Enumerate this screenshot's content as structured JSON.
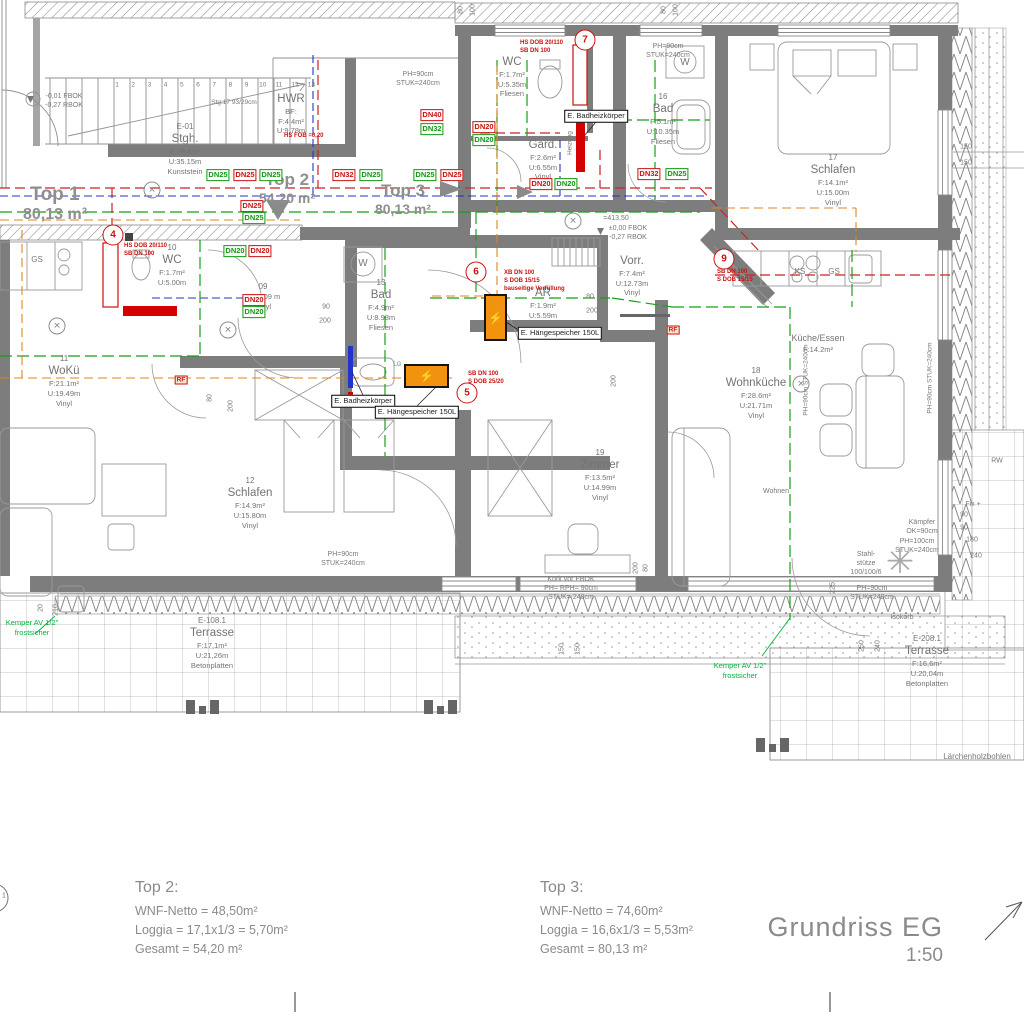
{
  "title": {
    "text": "Grundriss EG",
    "scale": "1:50"
  },
  "summaries": [
    {
      "heading": "Top 2:",
      "lines": [
        "WNF-Netto = 48,50m²",
        "Loggia = 17,1x1/3 = 5,70m²",
        "Gesamt = 54,20 m²"
      ]
    },
    {
      "heading": "Top 3:",
      "lines": [
        "WNF-Netto = 74,60m²",
        "Loggia = 16,6x1/3 = 5,53m²",
        "Gesamt = 80,13 m²"
      ]
    }
  ],
  "units": [
    {
      "name": "Top 1",
      "area": "80,13 m²",
      "x": 55,
      "y": 184,
      "size": 19
    },
    {
      "name": "Top 2",
      "area": "54,20 m²",
      "x": 287,
      "y": 170,
      "size": 17
    },
    {
      "name": "Top 3",
      "area": "80,13 m²",
      "x": ": 0",
      "size": 0
    },
    {
      "name": "Top 3",
      "area": "80,13 m²",
      "x": 403,
      "y": 181,
      "size": 17
    }
  ],
  "rooms": [
    {
      "number": "E-01",
      "name": "Stgh.",
      "lines": [
        "F:29.6m²",
        "U:35.15m",
        "Kunststein"
      ],
      "x": 185,
      "y": 122
    },
    {
      "number": "",
      "name": "HWR",
      "lines": [
        "BF:",
        "F:4.4m²",
        "U:9.78m"
      ],
      "x": 291,
      "y": 92
    },
    {
      "number": "",
      "name": "WC",
      "lines": [
        "F:1.7m²",
        "U:5.35m",
        "Fliesen"
      ],
      "x": 512,
      "y": 55
    },
    {
      "number": "",
      "name": "Gard.",
      "lines": [
        "F:2.6m²",
        "U:6.55m",
        "Vinyl"
      ],
      "x": 543,
      "y": 138
    },
    {
      "number": "16",
      "name": "Bad",
      "lines": [
        "F:5.1m²",
        "U:10.35m",
        "Fliesen"
      ],
      "x": 663,
      "y": 92
    },
    {
      "number": "17",
      "name": "Schlafen",
      "lines": [
        "F:14.1m²",
        "U:15.00m",
        "Vinyl"
      ],
      "x": 833,
      "y": 153
    },
    {
      "number": "10",
      "name": "WC",
      "lines": [
        "F:1.7m²",
        "U:5.00m"
      ],
      "x": 172,
      "y": 243
    },
    {
      "number": "09",
      "name": "",
      "lines": [
        "U:10.09 m",
        "Vinyl"
      ],
      "x": 263,
      "y": 282
    },
    {
      "number": "11",
      "name": "WoKü",
      "lines": [
        "F:21.1m²",
        "U:19.49m",
        "Vinyl"
      ],
      "x": 64,
      "y": 354
    },
    {
      "number": "13",
      "name": "Bad",
      "lines": [
        "F:4.9m²",
        "U:8.98m",
        "Fliesen"
      ],
      "x": 381,
      "y": 278
    },
    {
      "number": "",
      "name": "AR",
      "lines": [
        "F:1.9m²",
        "U:5.59m"
      ],
      "x": 543,
      "y": 286
    },
    {
      "number": "",
      "name": "Vorr.",
      "lines": [
        "F:7.4m²",
        "U:12.73m",
        "Vinyl"
      ],
      "x": 632,
      "y": 254
    },
    {
      "number": "12",
      "name": "Schlafen",
      "lines": [
        "F:14.9m²",
        "U:15.80m",
        "Vinyl"
      ],
      "x": 250,
      "y": 476
    },
    {
      "number": "19",
      "name": "Zimmer",
      "lines": [
        "F:13.5m²",
        "U:14.99m",
        "Vinyl"
      ],
      "x": 600,
      "y": 448
    },
    {
      "number": "18",
      "name": "Wohnküche",
      "lines": [
        "F:28.6m²",
        "U:21.71m",
        "Vinyl"
      ],
      "x": 756,
      "y": 366
    },
    {
      "number": "",
      "name": "Küche/Essen",
      "small": true,
      "lines": [
        "F:14.2m²"
      ],
      "x": 818,
      "y": 333
    },
    {
      "number": "E-108.1",
      "name": "Terrasse",
      "lines": [
        "F:17,1m²",
        "U:21,26m",
        "Betonplatten"
      ],
      "x": 212,
      "y": 616
    },
    {
      "number": "E-208.1",
      "name": "Terrasse",
      "lines": [
        "F:16,6m²",
        "U:20,04m",
        "Betonplatten"
      ],
      "x": 927,
      "y": 634
    }
  ],
  "dn_labels": [
    {
      "t": "DN25",
      "c": "green",
      "x": 218,
      "y": 175
    },
    {
      "t": "DN25",
      "c": "red",
      "x": 245,
      "y": 175
    },
    {
      "t": "DN25",
      "c": "green",
      "x": 271,
      "y": 175
    },
    {
      "t": "DN32",
      "c": "red",
      "x": 344,
      "y": 175
    },
    {
      "t": "DN25",
      "c": "green",
      "x": 371,
      "y": 175
    },
    {
      "t": "DN25",
      "c": "green",
      "x": 425,
      "y": 175
    },
    {
      "t": "DN25",
      "c": "red",
      "x": 452,
      "y": 175
    },
    {
      "t": "DN25",
      "c": "red",
      "x": 252,
      "y": 206
    },
    {
      "t": "DN25",
      "c": "green",
      "x": 254,
      "y": 218
    },
    {
      "t": "DN40",
      "c": "red",
      "x": 432,
      "y": 115
    },
    {
      "t": "DN32",
      "c": "green",
      "x": 432,
      "y": 129
    },
    {
      "t": "DN20",
      "c": "red",
      "x": 484,
      "y": 127
    },
    {
      "t": "DN20",
      "c": "green",
      "x": 484,
      "y": 140
    },
    {
      "t": "DN20",
      "c": "green",
      "x": 235,
      "y": 251
    },
    {
      "t": "DN20",
      "c": "red",
      "x": 260,
      "y": 251
    },
    {
      "t": "DN20",
      "c": "red",
      "x": 254,
      "y": 300
    },
    {
      "t": "DN20",
      "c": "green",
      "x": 254,
      "y": 312
    },
    {
      "t": "DN20",
      "c": "red",
      "x": 541,
      "y": 184
    },
    {
      "t": "DN20",
      "c": "green",
      "x": 566,
      "y": 184
    },
    {
      "t": "DN32",
      "c": "red",
      "x": 649,
      "y": 174
    },
    {
      "t": "DN25",
      "c": "green",
      "x": 677,
      "y": 174
    }
  ],
  "markers": [
    {
      "n": "4",
      "x": 113,
      "y": 235
    },
    {
      "n": "5",
      "x": 467,
      "y": 393
    },
    {
      "n": "6",
      "x": 476,
      "y": 272
    },
    {
      "n": "7",
      "x": 585,
      "y": 40
    },
    {
      "n": "9",
      "x": 724,
      "y": 259
    }
  ],
  "boxed_labels": [
    {
      "t": "E. Badheizkörper",
      "x": 596,
      "y": 116
    },
    {
      "t": "E. Badheizkörper",
      "x": 363,
      "y": 401
    },
    {
      "t": "E. Hängespeicher 150L",
      "x": 560,
      "y": 333
    },
    {
      "t": "E. Hängespeicher 150L",
      "x": 417,
      "y": 412
    }
  ],
  "red_notes": [
    {
      "lines": [
        "HS DOB 20/110",
        "SB DN 100"
      ],
      "x": 124,
      "y": 243
    },
    {
      "lines": [
        "HS DOB 20/110",
        "SB DN 100"
      ],
      "x": 520,
      "y": 40
    },
    {
      "lines": [
        "HS FOB =0,20"
      ],
      "x": 284,
      "y": 133
    },
    {
      "lines": [
        "XB DN 100",
        "S DOB 15/15",
        "bauseitige Verfüllung"
      ],
      "x": 504,
      "y": 270
    },
    {
      "lines": [
        "SB DN 100",
        "S DOB 25/20"
      ],
      "x": 468,
      "y": 371
    },
    {
      "lines": [
        "SB DN 100",
        "S DOB 15/15"
      ],
      "x": 717,
      "y": 269
    }
  ],
  "green_notes": [
    {
      "lines": [
        "Kemper AV 1/2\"",
        "frostsicher"
      ],
      "x": 32,
      "y": 618
    },
    {
      "lines": [
        "Kemper AV 1/2\"",
        "frostsicher"
      ],
      "x": 740,
      "y": 661
    }
  ],
  "gray_notes": [
    {
      "lines": [
        "-0,01 FBOK",
        "-0,27 RBOK"
      ],
      "x": 64,
      "y": 92
    },
    {
      "lines": [
        "=413,50"
      ],
      "x": 616,
      "y": 214
    },
    {
      "lines": [
        "±0,00 FBOK",
        "-0,27 RBOK"
      ],
      "x": 628,
      "y": 224
    },
    {
      "lines": [
        "Stg:17 93/29cm"
      ],
      "x": 234,
      "y": 99,
      "size": 6.5
    },
    {
      "lines": [
        "PH=90cm",
        "STUK=240cm"
      ],
      "x": 418,
      "y": 70
    },
    {
      "lines": [
        "PH=90cm",
        "STUK=240cm"
      ],
      "x": 668,
      "y": 42
    },
    {
      "lines": [
        "PH=90cm",
        "STUK=240cm"
      ],
      "x": 343,
      "y": 550
    },
    {
      "lines": [
        "Kork vor FBOK",
        "PH= RPH= 90cm",
        "STUK= 240cm"
      ],
      "x": 571,
      "y": 575
    },
    {
      "lines": [
        "Kämpfer",
        "OK=90cm"
      ],
      "x": 922,
      "y": 518
    },
    {
      "lines": [
        "PH=100cm",
        "STUK=240cm"
      ],
      "x": 917,
      "y": 537
    },
    {
      "lines": [
        "PH=90cm",
        "STUK=240cm"
      ],
      "x": 872,
      "y": 584
    },
    {
      "lines": [
        "Stahl-",
        "stütze",
        "100/100/6"
      ],
      "x": 866,
      "y": 550
    },
    {
      "lines": [
        "Wohnen"
      ],
      "x": 776,
      "y": 487
    },
    {
      "lines": [
        "Isokorb"
      ],
      "x": 902,
      "y": 613
    },
    {
      "lines": [
        "Lärchenholzbohlen"
      ],
      "x": 977,
      "y": 752,
      "size": 8
    },
    {
      "lines": [
        "Fix +"
      ],
      "x": 973,
      "y": 500
    },
    {
      "lines": [
        "GS"
      ],
      "x": 37,
      "y": 255,
      "size": 8
    },
    {
      "lines": [
        "KS"
      ],
      "x": 800,
      "y": 267,
      "size": 8
    },
    {
      "lines": [
        "GS"
      ],
      "x": 834,
      "y": 267,
      "size": 8
    },
    {
      "lines": [
        "W"
      ],
      "x": 685,
      "y": 56,
      "size": 10
    },
    {
      "lines": [
        "W"
      ],
      "x": 363,
      "y": 257,
      "size": 10
    },
    {
      "lines": [
        "Lü"
      ],
      "x": 397,
      "y": 360
    }
  ],
  "rot_notes": [
    {
      "t": "PH=90cm STUK=240cm",
      "x": 930,
      "y": 378
    },
    {
      "t": "PH=90cm STUK=240cm",
      "x": 806,
      "y": 380
    },
    {
      "t": "Heizung",
      "x": 570,
      "y": 143
    }
  ],
  "dims": [
    {
      "t": "150",
      "x": 966,
      "y": 147
    },
    {
      "t": "150",
      "x": 966,
      "y": 163
    },
    {
      "t": "90",
      "x": 964,
      "y": 515
    },
    {
      "t": "90",
      "x": 964,
      "y": 528
    },
    {
      "t": "180",
      "x": 972,
      "y": 540
    },
    {
      "t": "240",
      "x": 976,
      "y": 556
    },
    {
      "t": "225",
      "x": 833,
      "y": 588,
      "rot": 1
    },
    {
      "t": "250",
      "x": 862,
      "y": 646,
      "rot": 1
    },
    {
      "t": "240",
      "x": 878,
      "y": 646,
      "rot": 1
    },
    {
      "t": "20",
      "x": 41,
      "y": 608,
      "rot": 1
    },
    {
      "t": "210",
      "x": 56,
      "y": 610,
      "rot": 1
    },
    {
      "t": "150",
      "x": 562,
      "y": 649,
      "rot": 1
    },
    {
      "t": "150",
      "x": 578,
      "y": 649,
      "rot": 1
    },
    {
      "t": "80",
      "x": 461,
      "y": 10,
      "rot": 1
    },
    {
      "t": "100",
      "x": 473,
      "y": 10,
      "rot": 1
    },
    {
      "t": "80",
      "x": 664,
      "y": 10,
      "rot": 1
    },
    {
      "t": "100",
      "x": 676,
      "y": 10,
      "rot": 1
    },
    {
      "t": "80",
      "x": 210,
      "y": 398,
      "rot": 1
    },
    {
      "t": "200",
      "x": 231,
      "y": 406,
      "rot": 1
    },
    {
      "t": "90",
      "x": 326,
      "y": 307
    },
    {
      "t": "200",
      "x": 325,
      "y": 321
    },
    {
      "t": "80",
      "x": 590,
      "y": 297
    },
    {
      "t": "200",
      "x": 592,
      "y": 311
    },
    {
      "t": "80",
      "x": 646,
      "y": 568,
      "rot": 1
    },
    {
      "t": "200",
      "x": 636,
      "y": 568,
      "rot": 1
    },
    {
      "t": "200",
      "x": 614,
      "y": 381,
      "rot": 1
    },
    {
      "t": "1",
      "x": 4,
      "y": 896
    }
  ],
  "stair_numbers": {
    "labels": [
      "1",
      "2",
      "3",
      "4",
      "5",
      "6",
      "7",
      "8",
      "9",
      "10",
      "11",
      "12",
      "13"
    ],
    "x0": 117,
    "dx": 16.2,
    "y": 85
  },
  "xcircles": [
    {
      "x": 152,
      "y": 190
    },
    {
      "x": 57,
      "y": 326
    },
    {
      "x": 228,
      "y": 330
    },
    {
      "x": 801,
      "y": 384
    },
    {
      "x": 573,
      "y": 221
    }
  ],
  "heaters": [
    {
      "x": 484,
      "y": 294,
      "w": 19,
      "h": 43
    },
    {
      "x": 404,
      "y": 364,
      "w": 41,
      "h": 20
    }
  ],
  "rf_markers": [
    {
      "t": "RF",
      "x": 181,
      "y": 380
    },
    {
      "t": "RF",
      "x": 673,
      "y": 330
    }
  ],
  "symbols": [
    {
      "glyph": "✳",
      "x": 900,
      "y": 562,
      "size": 34,
      "name": "plant-symbol"
    }
  ],
  "icons": {
    "lamp_glyph": "✕",
    "bolt_glyph": "⚡"
  },
  "edge_labels": [
    {
      "t": "RW",
      "x": 997,
      "y": 461
    }
  ]
}
